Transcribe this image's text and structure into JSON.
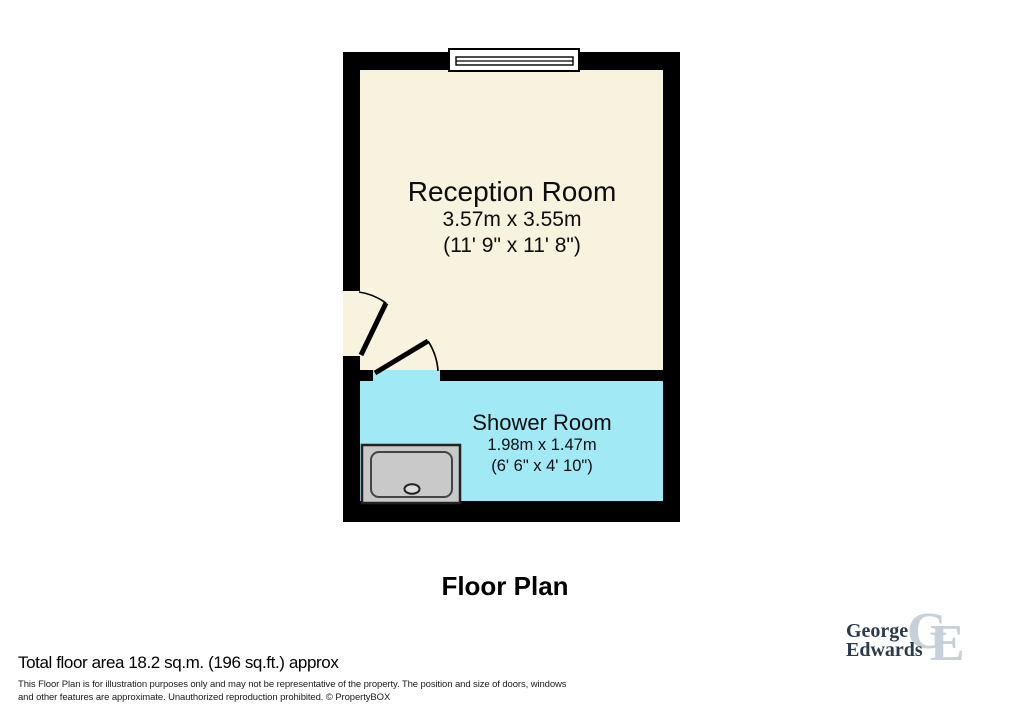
{
  "title": "Floor Plan",
  "plan": {
    "rooms": [
      {
        "name": "Reception Room",
        "dimensions_metric": "3.57m x 3.55m",
        "dimensions_imperial": "(11' 9\" x 11' 8\")",
        "floor_color": "#F8F3DE"
      },
      {
        "name": "Shower Room",
        "dimensions_metric": "1.98m x 1.47m",
        "dimensions_imperial": "(6' 6\" x 4' 10\")",
        "floor_color": "#A2E9F6"
      }
    ],
    "features": [
      "window",
      "entry-door",
      "shower-room-door",
      "shower-tray"
    ]
  },
  "footer": {
    "total_area": "Total floor area 18.2 sq.m. (196 sq.ft.) approx",
    "disclaimer_line1": "This Floor Plan is for illustration purposes only and may not be representative of the property. The position and size of doors, windows",
    "disclaimer_line2": "and other features are approximate. Unauthorized reproduction prohibited. © PropertyBOX"
  },
  "logo": {
    "word1": "George",
    "word2": "Edwards",
    "monogram_g": "G",
    "monogram_e": "E"
  },
  "colors": {
    "wall": "#000000",
    "reception_floor": "#F8F3DE",
    "shower_floor": "#A2E9F6",
    "window_fill": "#FFFFFF",
    "tray_fill": "#C9C9C9",
    "tray_drain": "#DDDDDD",
    "logo_navy": "#2B3B4D",
    "logo_light": "#C8D1D9"
  }
}
